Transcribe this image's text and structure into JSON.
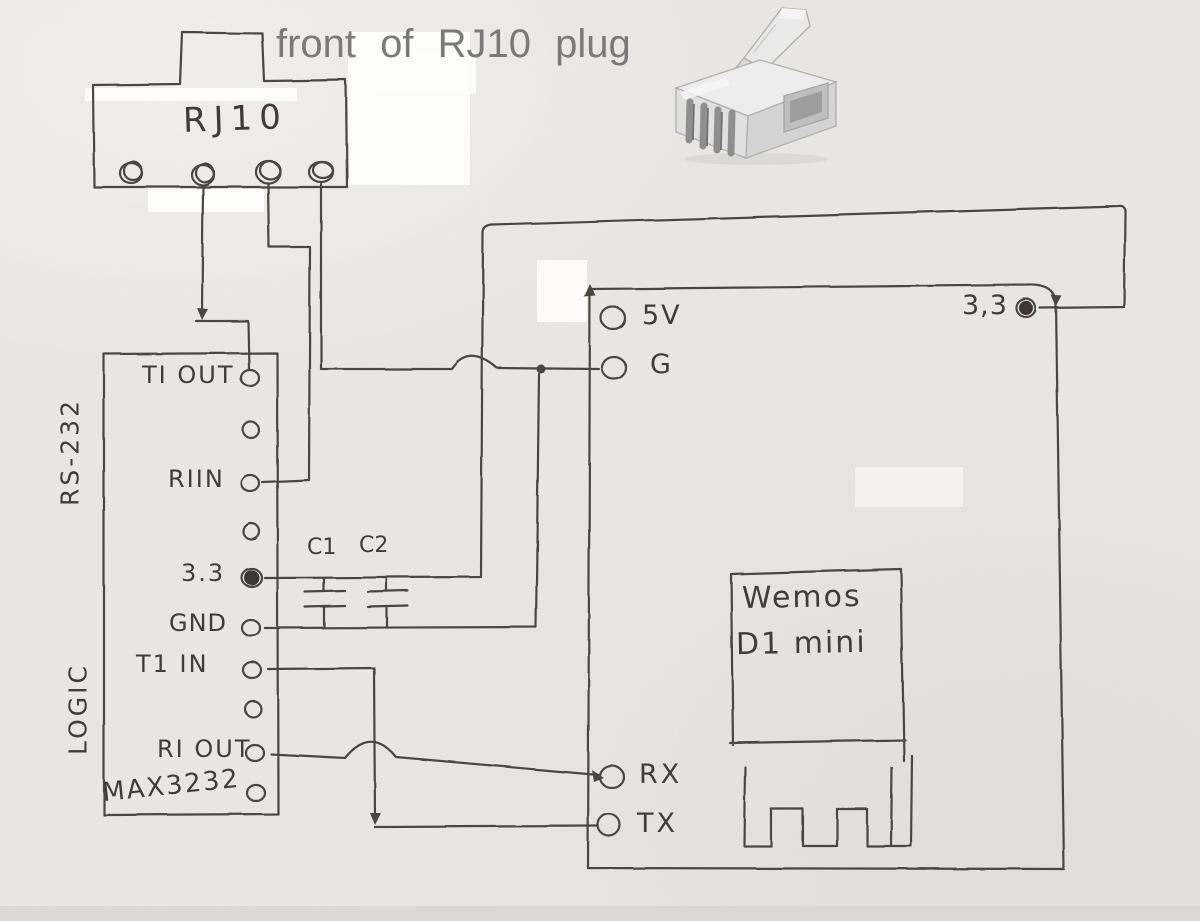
{
  "annotation": {
    "text": "front of RJ10 plug"
  },
  "rj10": {
    "label": "RJ10"
  },
  "max3232": {
    "side_label_top": "RS-232",
    "side_label_bottom": "LOGIC",
    "chip_label": "MAX3232",
    "pin_labels": {
      "tiout": "TI OUT",
      "riin": "RIIN",
      "v33": "3.3",
      "gnd": "GND",
      "t1in": "T1 IN",
      "riout": "RI OUT"
    }
  },
  "capacitors": {
    "c1": "C1",
    "c2": "C2"
  },
  "wemos": {
    "pin_labels": {
      "v5": "5V",
      "g": "G",
      "v33": "3,3",
      "rx": "RX",
      "tx": "TX"
    },
    "module": {
      "line1": "Wemos",
      "line2": "D1 mini"
    }
  },
  "colors": {
    "pencil": "#4a4742",
    "handwriting": "#403d39",
    "annotation_gray": "#7a7a7a",
    "paper": "#eae8e4"
  }
}
